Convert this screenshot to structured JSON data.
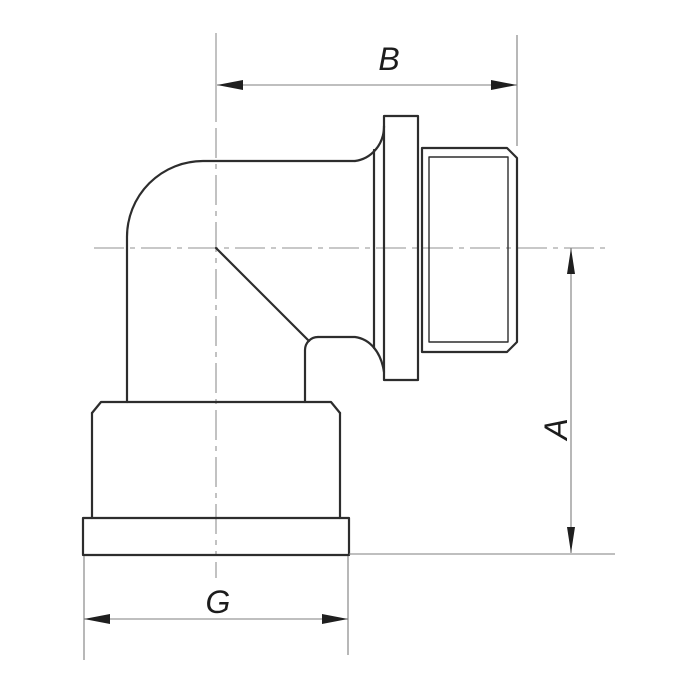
{
  "page": {
    "background": "#ffffff"
  },
  "diagram": {
    "type": "technical-drawing",
    "subject": "90-degree elbow pipe fitting, side elevation: male threaded outlet with collar on the right, flanged female socket at the bottom",
    "colors": {
      "outline": "#2d2d2d",
      "dimension_line": "#7f7f7f",
      "centerline": "#909090",
      "arrowhead": "#1f1f1f",
      "label_text": "#1c1c1c"
    },
    "dimensions": [
      {
        "label": "B",
        "orientation": "horizontal",
        "position": "top",
        "extent": "vertical center axis to end of male thread"
      },
      {
        "label": "A",
        "orientation": "vertical",
        "position": "right",
        "extent": "horizontal center axis to bottom face of base flange"
      },
      {
        "label": "G",
        "orientation": "horizontal",
        "position": "bottom",
        "extent": "overall width of base flange"
      }
    ]
  }
}
